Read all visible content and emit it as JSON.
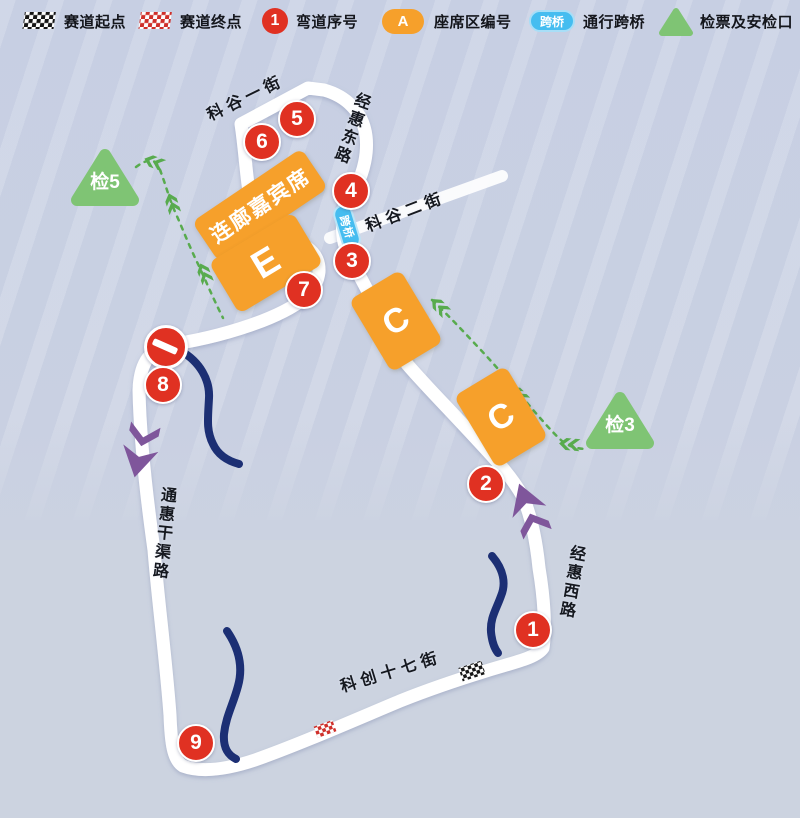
{
  "legend": {
    "start_label": "赛道起点",
    "finish_label": "赛道终点",
    "corner_badge": "1",
    "corner_label": "弯道序号",
    "stand_badge": "A",
    "stand_label": "座席区编号",
    "bridge_badge": "跨桥",
    "bridge_label": "通行跨桥",
    "checkpoint_label": "检票及安检口"
  },
  "map": {
    "corners": [
      {
        "num": "1"
      },
      {
        "num": "2"
      },
      {
        "num": "3"
      },
      {
        "num": "4"
      },
      {
        "num": "5"
      },
      {
        "num": "6"
      },
      {
        "num": "7"
      },
      {
        "num": "8"
      },
      {
        "num": "9"
      }
    ],
    "stands": {
      "gallery": "连廊嘉宾席",
      "e": "E",
      "c_upper": "C",
      "c_lower": "C"
    },
    "checkpoints": {
      "cp5": "检5",
      "cp3": "检3"
    },
    "bridge_badge": "跨桥",
    "streets": {
      "kegu_yijie": "科谷一街",
      "jinghui_donglu": "经惠东路",
      "kegu_erjie": "科谷二街",
      "tonghui_ganqulu": "通惠干渠路",
      "jinghui_xilu": "经惠西路",
      "kechuang_shiqijie": "科创十七街"
    }
  },
  "colors": {
    "corner_red": "#e03122",
    "stand_orange": "#f6a02b",
    "checkpoint_green": "#7fc474",
    "bridge_blue": "#45bdf0",
    "arrow_purple": "#7f569b",
    "river_navy": "#1c2f74",
    "track_white": "#ffffff",
    "background": "#c8cfe3"
  }
}
